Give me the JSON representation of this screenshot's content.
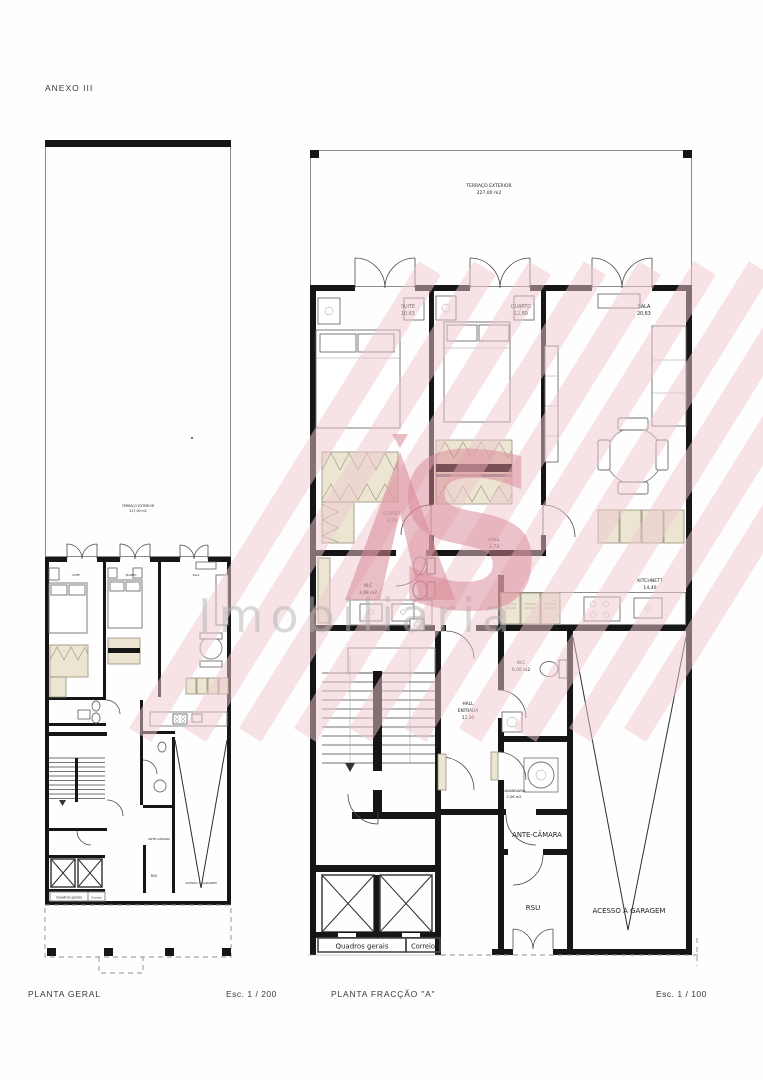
{
  "sheet": {
    "annex_label": "ANEXO III"
  },
  "watermark": {
    "monogram_a": "A",
    "monogram_s": "S",
    "brand_name": "Imobiliária",
    "stripe_color": "#f1c9cf",
    "logo_color": "#d98895",
    "text_color": "#b3b3b3"
  },
  "plans": {
    "geral": {
      "title": "PLANTA GERAL",
      "scale_label": "Esc. 1 / 200"
    },
    "fraccao_a": {
      "title": "PLANTA  FRACÇÃO  \"A\"",
      "scale_label": "Esc. 1 / 100"
    }
  },
  "rooms": {
    "terraco": {
      "name": "TERRAÇO EXTERIOR",
      "area": "227,00 m2"
    },
    "suite": {
      "name": "SUITE",
      "area": "10,83"
    },
    "quarto": {
      "name": "QUARTO",
      "area": "12,80"
    },
    "sala": {
      "name": "SALA",
      "area": "20,63"
    },
    "closet": {
      "name": "CLOSET",
      "area": "3,70"
    },
    "hall": {
      "name": "HALL",
      "area": "3,73"
    },
    "wc_suite": {
      "name": "W.C",
      "area": "3,99 m2"
    },
    "kitchnett": {
      "name": "KITCHNETT",
      "area": "14,40"
    },
    "wc_servico": {
      "name": "W.C",
      "area": "6,00 m2"
    },
    "hall_entrada": {
      "line1": "HALL",
      "line2": "ENTRADA",
      "area": "12,30"
    },
    "lavandaria": {
      "name": "LAVANDARIA",
      "area": "2,06 m2"
    },
    "ante_camara": {
      "name": "ANTE-CÂMARA"
    },
    "rsu": {
      "name": "RSU"
    },
    "acesso_garagem": {
      "name": "ACESSO À GARAGEM"
    },
    "quadros_gerais": {
      "name": "Quadros gerais"
    },
    "correio": {
      "name": "Correio"
    }
  }
}
